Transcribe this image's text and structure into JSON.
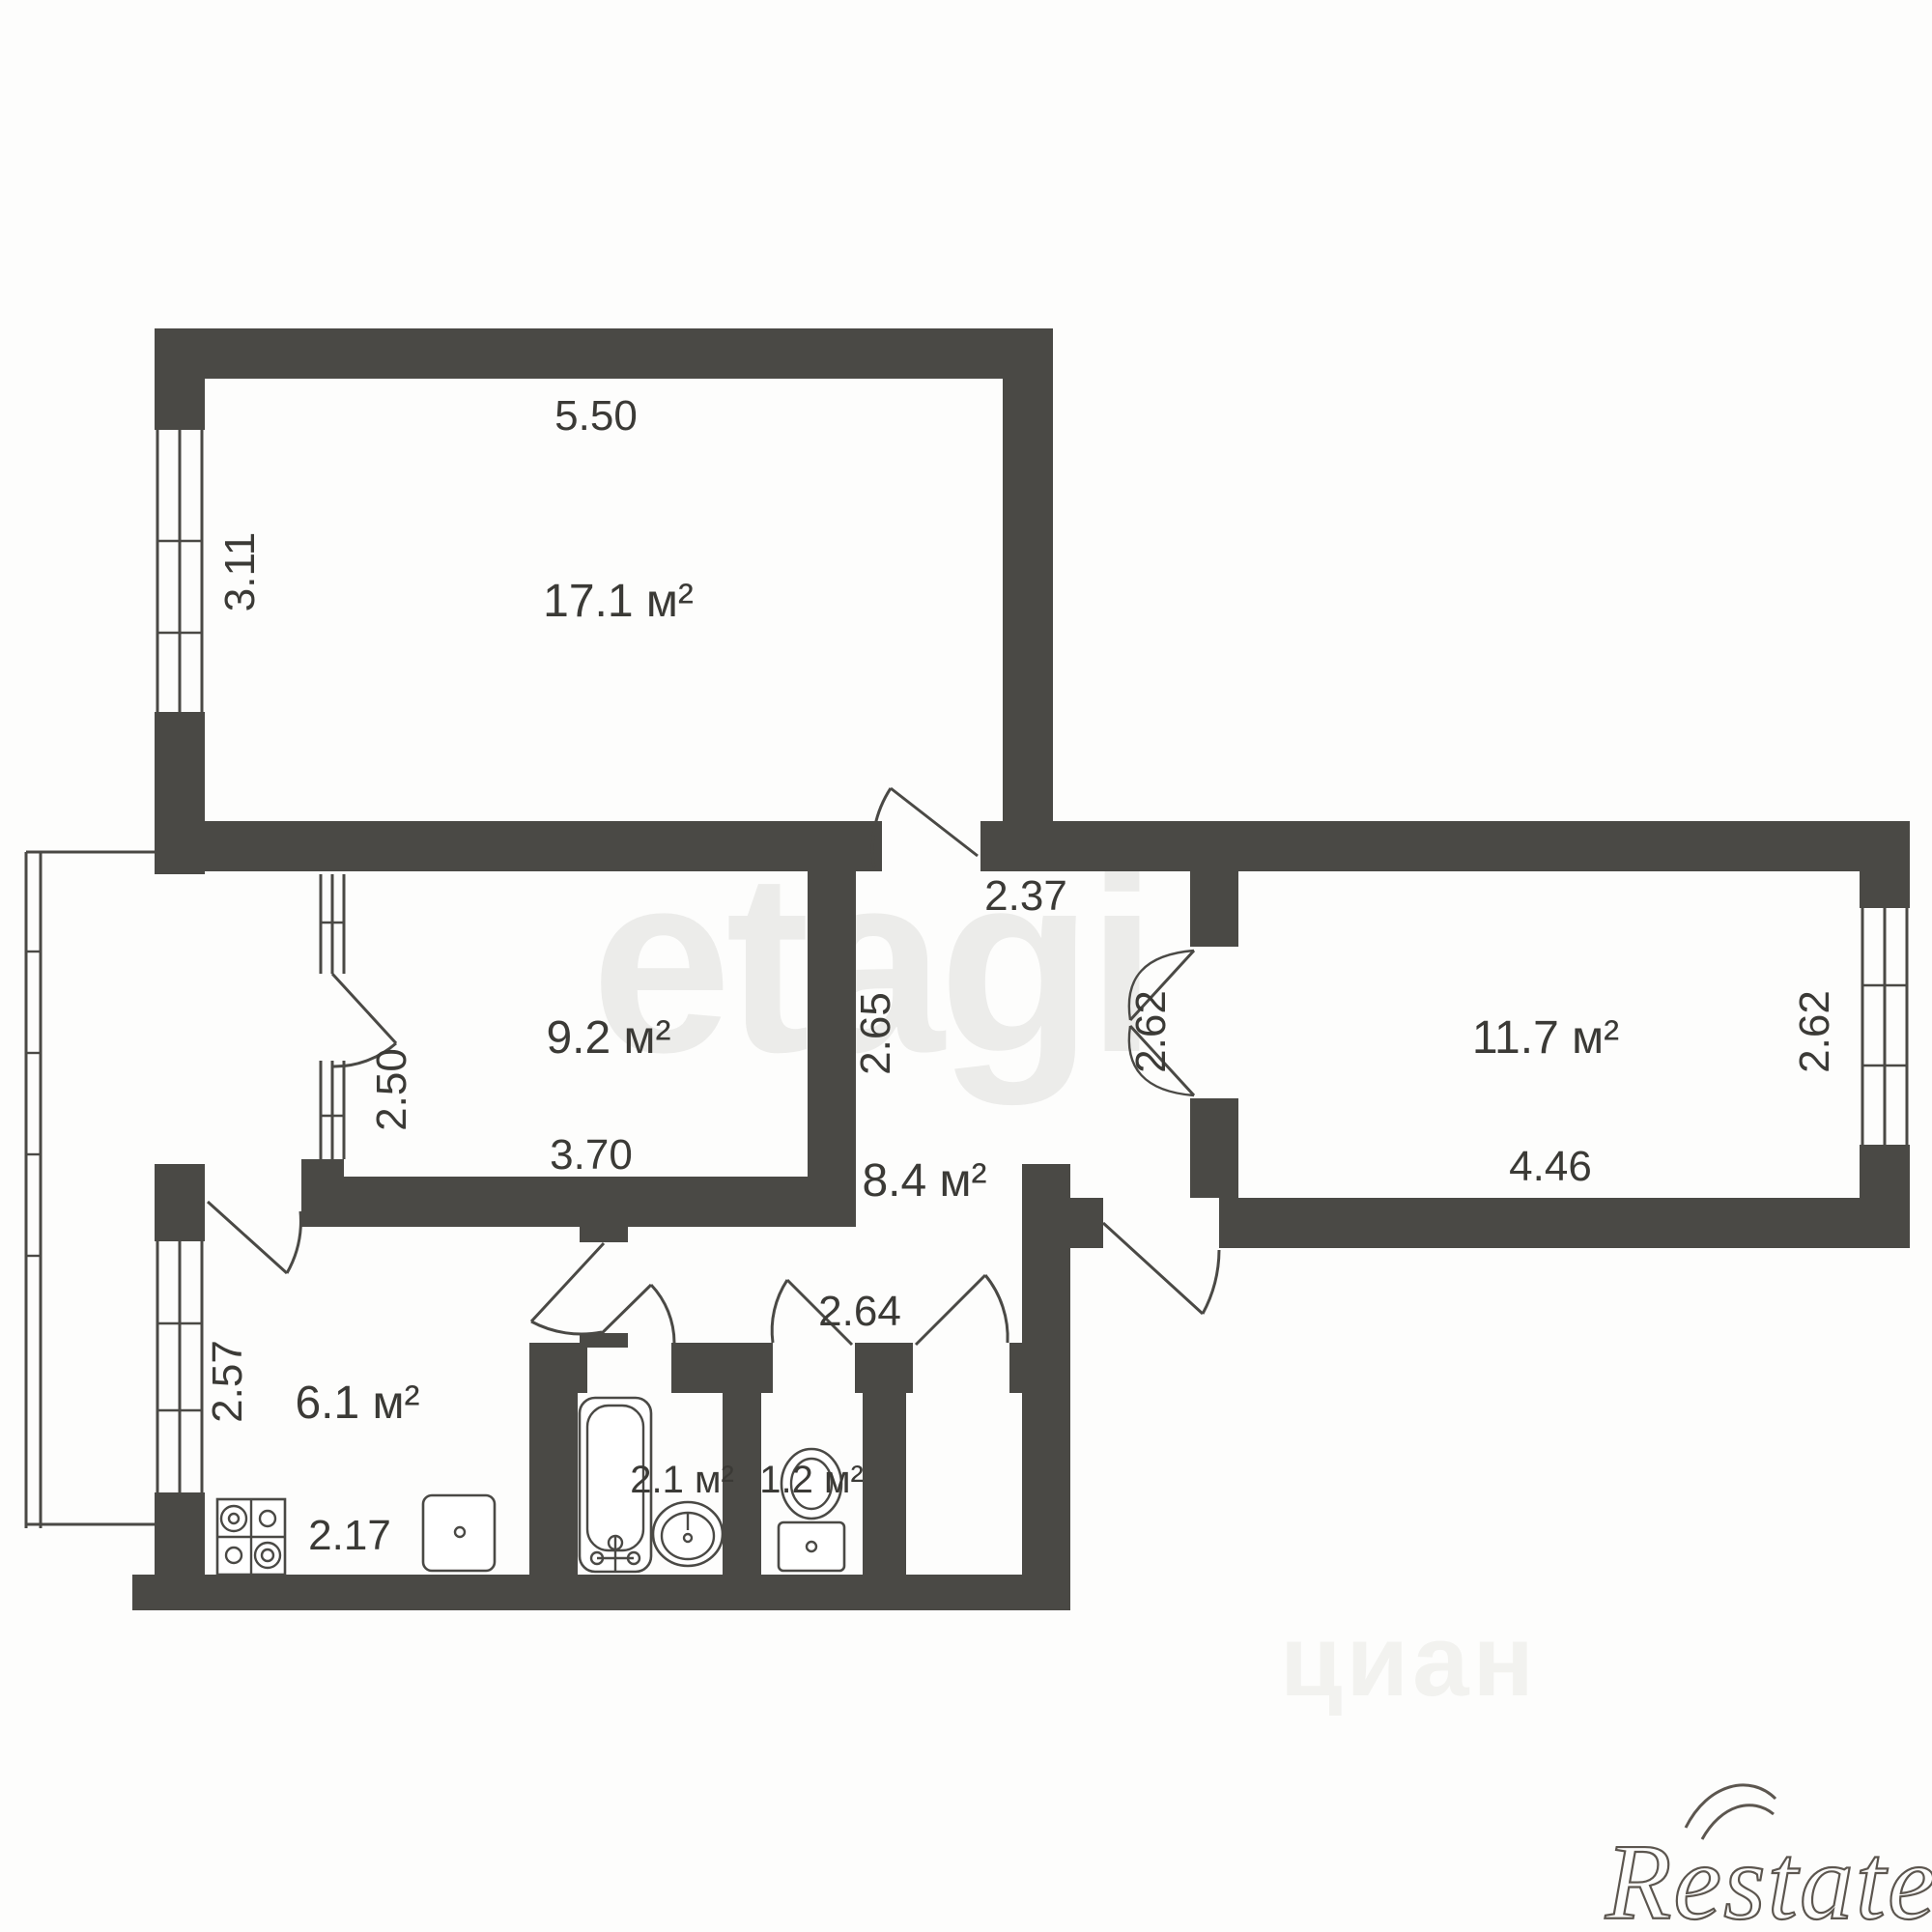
{
  "plan_title": "2-room apartment floor plan",
  "rooms": {
    "living": {
      "area": "17.1 м²",
      "width": "5.50",
      "window_height": "3.11"
    },
    "bedroom": {
      "area": "9.2 м²",
      "width": "3.70",
      "balcony_door_height": "2.50"
    },
    "right_room": {
      "area": "11.7 м²",
      "width": "4.46",
      "window_height": "2.62",
      "door_height": "2.62"
    },
    "hallway": {
      "area": "8.4 м²",
      "width": "2.37",
      "height": "2.65",
      "corridor_width": "2.64"
    },
    "kitchen": {
      "area": "6.1 м²",
      "width": "2.17",
      "height": "2.57"
    },
    "bathroom": {
      "area": "2.1 м²"
    },
    "wc": {
      "area": "1.2 м²"
    }
  },
  "fixtures": [
    "stove",
    "kitchen-sink",
    "bathtub",
    "washbasin",
    "toilet"
  ],
  "watermarks": {
    "center": "etagi",
    "bottom": "циан",
    "brand": "Restate"
  },
  "colors": {
    "wall": "#4a4945",
    "text": "#3b3a36",
    "watermark_center": "#ececea",
    "watermark_bottom": "#f2f2ef",
    "brand": "#5c564f",
    "background": "#fdfdfc"
  }
}
